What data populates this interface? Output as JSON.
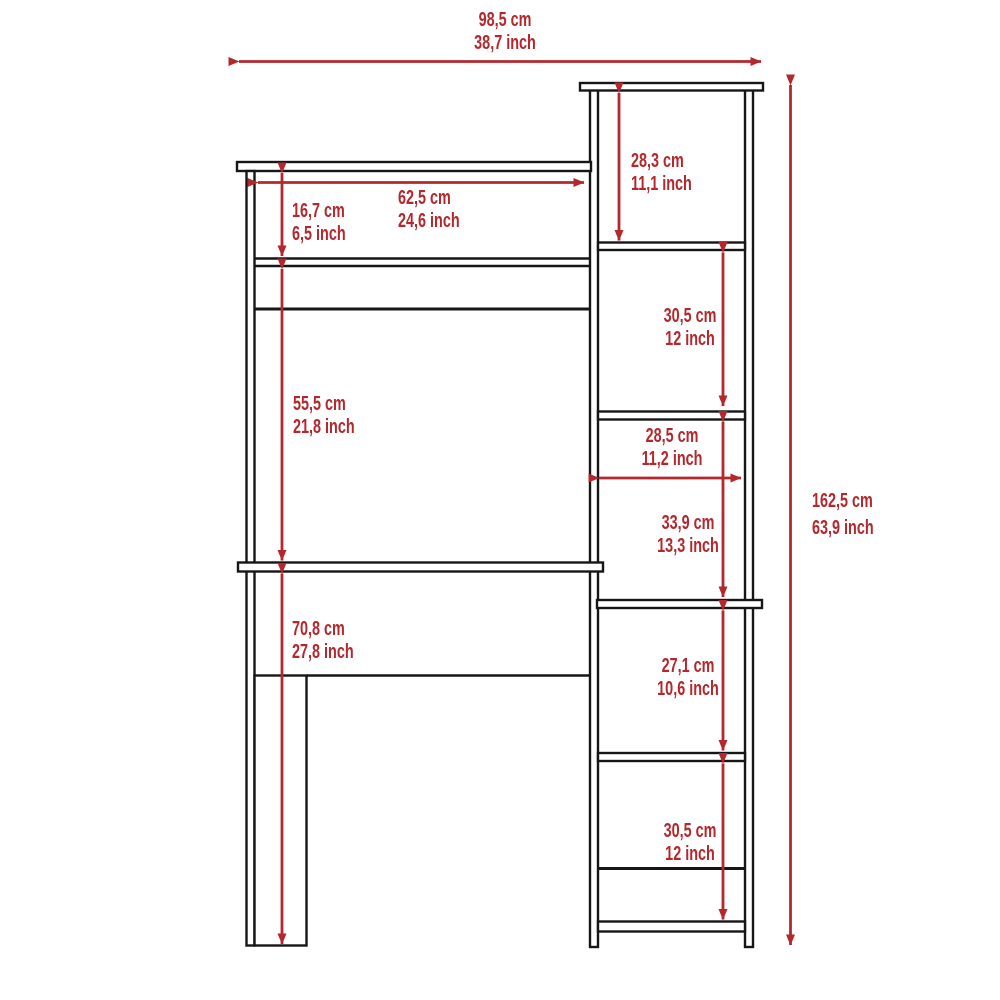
{
  "colors": {
    "accent": "#b4282d",
    "line": "#161616",
    "background": "#ffffff"
  },
  "diagram_type": "furniture dimension drawing: desk with hutch and side bookcase",
  "units_shown": [
    "cm",
    "inch"
  ],
  "dimensions": {
    "total_width": {
      "cm": "98,5 cm",
      "inch": "38,7 inch"
    },
    "total_height": {
      "cm": "162,5 cm",
      "inch": "63,9 inch"
    },
    "hutch_shelf_width": {
      "cm": "62,5 cm",
      "inch": "24,6 inch"
    },
    "hutch_top_height": {
      "cm": "16,7 cm",
      "inch": "6,5 inch"
    },
    "hutch_mid_height": {
      "cm": "55,5 cm",
      "inch": "21,8 inch"
    },
    "desk_clearance": {
      "cm": "70,8 cm",
      "inch": "27,8 inch"
    },
    "bookcase_cubby_1": {
      "cm": "28,3 cm",
      "inch": "11,1 inch"
    },
    "bookcase_cubby_2": {
      "cm": "30,5 cm",
      "inch": "12 inch"
    },
    "bookcase_width": {
      "cm": "28,5 cm",
      "inch": "11,2 inch"
    },
    "bookcase_cubby_3": {
      "cm": "33,9 cm",
      "inch": "13,3 inch"
    },
    "bookcase_cubby_4": {
      "cm": "27,1 cm",
      "inch": "10,6 inch"
    },
    "bookcase_cubby_5": {
      "cm": "30,5 cm",
      "inch": "12 inch"
    }
  }
}
